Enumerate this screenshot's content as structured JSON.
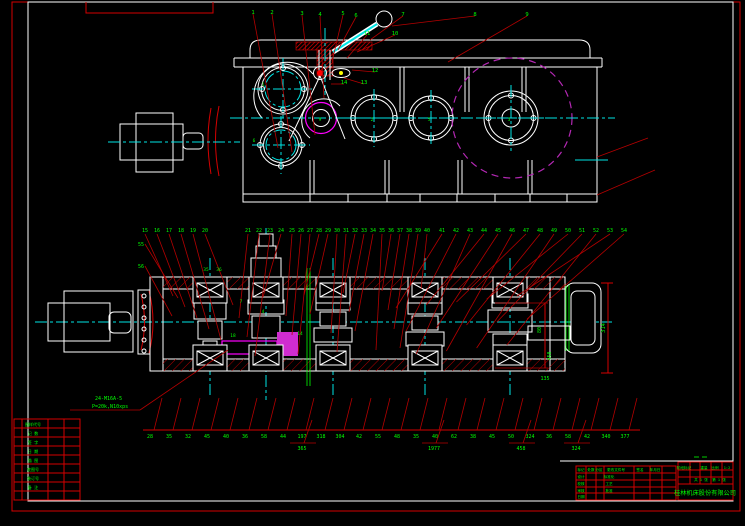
{
  "drawing": {
    "note_line1": "24-M16A-5",
    "note_line2": "P=20k,N10xps",
    "right_dim": "314",
    "mid_dim_a": "80",
    "mid_dim_b": "450",
    "mid_dim_c": "135",
    "top_view": {
      "balloons": [
        {
          "x": 253,
          "y": 12,
          "t": "1",
          "tx": 278,
          "ty": 148
        },
        {
          "x": 272,
          "y": 12,
          "t": "2",
          "tx": 292,
          "ty": 152
        },
        {
          "x": 302,
          "y": 13,
          "t": "3",
          "tx": 315,
          "ty": 135
        },
        {
          "x": 320,
          "y": 14,
          "t": "4",
          "tx": 324,
          "ty": 98
        },
        {
          "x": 343,
          "y": 13,
          "t": "5",
          "tx": 332,
          "ty": 62
        },
        {
          "x": 356,
          "y": 15,
          "t": "6",
          "tx": 338,
          "ty": 50
        },
        {
          "x": 403,
          "y": 14,
          "t": "7",
          "tx": 370,
          "ty": 40
        },
        {
          "x": 475,
          "y": 14,
          "t": "8",
          "tx": 392,
          "ty": 26
        },
        {
          "x": 527,
          "y": 14,
          "t": "9",
          "tx": 448,
          "ty": 62
        },
        {
          "x": 395,
          "y": 33,
          "t": "10",
          "tx": 357,
          "ty": 52
        },
        {
          "x": 367,
          "y": 33,
          "t": "11",
          "tx": 347,
          "ty": 58
        },
        {
          "x": 375,
          "y": 70,
          "t": "12",
          "tx": 352,
          "ty": 70
        },
        {
          "x": 364,
          "y": 82,
          "t": "13",
          "tx": 344,
          "ty": 78
        },
        {
          "x": 344,
          "y": 82,
          "t": "14",
          "tx": 331,
          "ty": 84
        }
      ],
      "center_glyphs": [
        {
          "x": 263,
          "y": 86,
          "t": "1"
        },
        {
          "x": 254,
          "y": 142,
          "t": "6"
        },
        {
          "x": 320,
          "y": 121,
          "t": "9"
        },
        {
          "x": 372,
          "y": 121,
          "t": "2"
        },
        {
          "x": 429,
          "y": 121,
          "t": "5"
        },
        {
          "x": 509,
          "y": 121,
          "t": "3"
        }
      ]
    },
    "section_view": {
      "balloon_y": 232,
      "balloons": [
        {
          "x": 145,
          "t": "15"
        },
        {
          "x": 157,
          "t": "16"
        },
        {
          "x": 169,
          "t": "17"
        },
        {
          "x": 181,
          "t": "18"
        },
        {
          "x": 193,
          "t": "19"
        },
        {
          "x": 205,
          "t": "20"
        },
        {
          "x": 248,
          "t": "21"
        },
        {
          "x": 259,
          "t": "22"
        },
        {
          "x": 270,
          "t": "23"
        },
        {
          "x": 281,
          "t": "24"
        },
        {
          "x": 292,
          "t": "25"
        },
        {
          "x": 301,
          "t": "26"
        },
        {
          "x": 310,
          "t": "27"
        },
        {
          "x": 319,
          "t": "28"
        },
        {
          "x": 328,
          "t": "29"
        },
        {
          "x": 337,
          "t": "30"
        },
        {
          "x": 346,
          "t": "31"
        },
        {
          "x": 355,
          "t": "32"
        },
        {
          "x": 364,
          "t": "33"
        },
        {
          "x": 373,
          "t": "34"
        },
        {
          "x": 382,
          "t": "35"
        },
        {
          "x": 391,
          "t": "36"
        },
        {
          "x": 400,
          "t": "37"
        },
        {
          "x": 409,
          "t": "38"
        },
        {
          "x": 418,
          "t": "39"
        },
        {
          "x": 427,
          "t": "40"
        },
        {
          "x": 442,
          "t": "41"
        },
        {
          "x": 456,
          "t": "42"
        },
        {
          "x": 470,
          "t": "43"
        },
        {
          "x": 484,
          "t": "44"
        },
        {
          "x": 498,
          "t": "45"
        },
        {
          "x": 512,
          "t": "46"
        },
        {
          "x": 526,
          "t": "47"
        },
        {
          "x": 540,
          "t": "48"
        },
        {
          "x": 554,
          "t": "49"
        },
        {
          "x": 568,
          "t": "50"
        },
        {
          "x": 582,
          "t": "51"
        },
        {
          "x": 596,
          "t": "52"
        },
        {
          "x": 610,
          "t": "53"
        },
        {
          "x": 624,
          "t": "54"
        }
      ],
      "left_labels": [
        {
          "x": 141,
          "y": 244,
          "t": "55",
          "tx": 178,
          "ty": 298
        },
        {
          "x": 141,
          "y": 266,
          "t": "56",
          "tx": 172,
          "ty": 316
        }
      ],
      "inner_labels": [
        {
          "x": 206,
          "y": 271,
          "t": "35"
        },
        {
          "x": 219,
          "y": 271,
          "t": "36"
        },
        {
          "x": 241,
          "y": 303,
          "t": "7"
        },
        {
          "x": 263,
          "y": 313,
          "t": "4"
        },
        {
          "x": 233,
          "y": 337,
          "t": "18"
        },
        {
          "x": 300,
          "y": 335,
          "t": "14"
        }
      ]
    },
    "bottom_dims": {
      "values": [
        {
          "x": 148,
          "t": "28"
        },
        {
          "x": 167,
          "t": "35"
        },
        {
          "x": 186,
          "t": "32"
        },
        {
          "x": 205,
          "t": "45"
        },
        {
          "x": 224,
          "t": "40"
        },
        {
          "x": 243,
          "t": "36"
        },
        {
          "x": 262,
          "t": "58"
        },
        {
          "x": 281,
          "t": "44"
        },
        {
          "x": 300,
          "t": "197"
        },
        {
          "x": 319,
          "t": "318"
        },
        {
          "x": 338,
          "t": "304"
        },
        {
          "x": 357,
          "t": "42"
        },
        {
          "x": 376,
          "t": "55"
        },
        {
          "x": 395,
          "t": "48"
        },
        {
          "x": 414,
          "t": "35"
        },
        {
          "x": 433,
          "t": "40"
        },
        {
          "x": 452,
          "t": "62"
        },
        {
          "x": 471,
          "t": "38"
        },
        {
          "x": 490,
          "t": "45"
        },
        {
          "x": 509,
          "t": "50"
        },
        {
          "x": 528,
          "t": "324"
        },
        {
          "x": 547,
          "t": "36"
        },
        {
          "x": 566,
          "t": "58"
        },
        {
          "x": 585,
          "t": "42"
        },
        {
          "x": 604,
          "t": "340"
        },
        {
          "x": 623,
          "t": "377"
        }
      ],
      "second_row": [
        {
          "x": 302,
          "t": "365"
        },
        {
          "x": 434,
          "t": "1977"
        },
        {
          "x": 521,
          "t": "458"
        },
        {
          "x": 576,
          "t": "324"
        }
      ]
    }
  },
  "title_block": {
    "company": "桂林机床股份有限公司",
    "texts": [
      {
        "x": 581,
        "y": 471,
        "t": "标记",
        "s": 3.6
      },
      {
        "x": 591,
        "y": 471,
        "t": "处数",
        "s": 3.6
      },
      {
        "x": 599,
        "y": 471,
        "t": "分区",
        "s": 3.6
      },
      {
        "x": 616,
        "y": 471,
        "t": "更改文件号",
        "s": 3.6
      },
      {
        "x": 640,
        "y": 471,
        "t": "签名",
        "s": 3.6
      },
      {
        "x": 655,
        "y": 471,
        "t": "年月日",
        "s": 3.6
      },
      {
        "x": 581,
        "y": 478,
        "t": "设计",
        "s": 3.6
      },
      {
        "x": 609,
        "y": 478,
        "t": "标准化",
        "s": 3.6
      },
      {
        "x": 581,
        "y": 485,
        "t": "校核",
        "s": 3.6
      },
      {
        "x": 609,
        "y": 485,
        "t": "工艺",
        "s": 3.6
      },
      {
        "x": 581,
        "y": 492,
        "t": "审核",
        "s": 3.6
      },
      {
        "x": 609,
        "y": 492,
        "t": "批准",
        "s": 3.6
      },
      {
        "x": 581,
        "y": 498,
        "t": "日期",
        "s": 3.6
      },
      {
        "x": 684,
        "y": 469,
        "t": "阶段标记",
        "s": 3.6
      },
      {
        "x": 704,
        "y": 469,
        "t": "重量",
        "s": 3.6
      },
      {
        "x": 715,
        "y": 469,
        "t": "比例",
        "s": 3.6
      },
      {
        "x": 727,
        "y": 469,
        "t": "1:2",
        "s": 3.6
      },
      {
        "x": 701,
        "y": 481,
        "t": "共 1 张",
        "s": 3.6
      },
      {
        "x": 719,
        "y": 481,
        "t": "第 1 张",
        "s": 3.6
      }
    ]
  },
  "left_strip": {
    "rows": [
      "图样代号",
      "记 数",
      "签 字",
      "日 期",
      "描 图",
      "底图号",
      "装订号",
      "备 注"
    ]
  }
}
